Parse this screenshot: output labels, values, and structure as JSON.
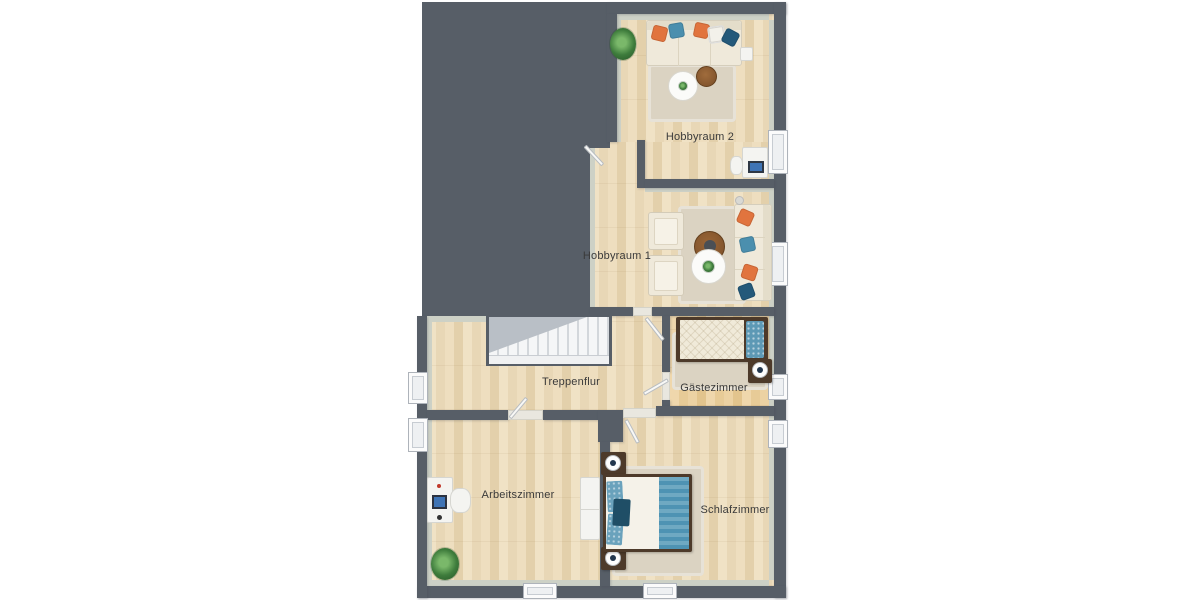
{
  "rooms": [
    {
      "label": "Hobbyraum 2"
    },
    {
      "label": "Hobbyraum 1"
    },
    {
      "label": "Treppenflur"
    },
    {
      "label": "Gästezimmer"
    },
    {
      "label": "Arbeitszimmer"
    },
    {
      "label": "Schlafzimmer"
    }
  ],
  "colors": {
    "wall": "#575e67",
    "wall_face": "#cdd1c6",
    "floor_a": "#f0e2c5",
    "floor_b": "#e3d0ab",
    "floor_warm_a": "#efd7ac",
    "floor_warm_b": "#e2c48d",
    "rug": "#dbd3c2",
    "stair": "#f5f6f7",
    "wood": "#4d3a2a",
    "sofa": "#efe9da",
    "orange": "#e1743e",
    "blue": "#4b8fae",
    "teal": "#24597a",
    "plant": "#3e7c3c",
    "label": "#3a3a3a",
    "screen": "#3f74b5"
  }
}
